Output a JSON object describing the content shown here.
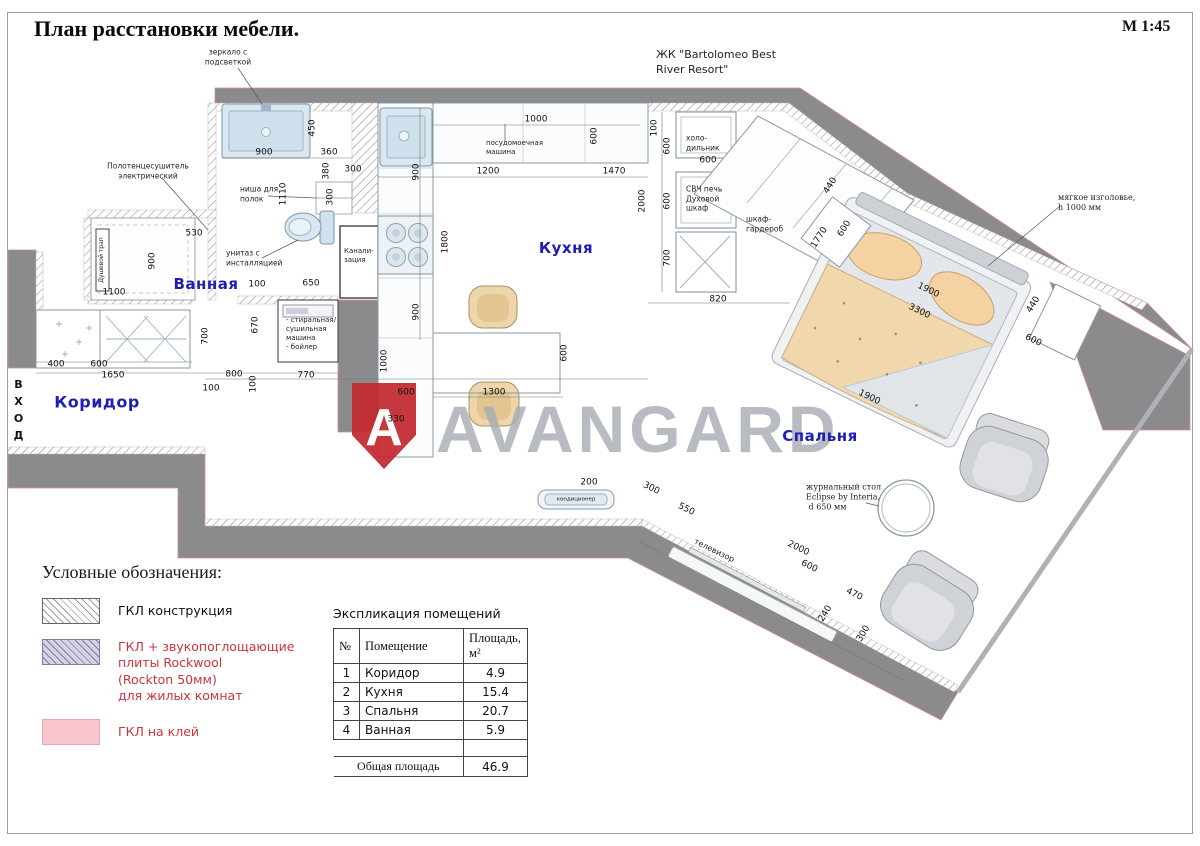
{
  "header": {
    "title": "План расстановки мебели.",
    "scale": "М 1:45",
    "project": "ЖК \"Bartolomeo Best\nRiver Resort\""
  },
  "entrance": {
    "label": "ВХОД"
  },
  "watermark": {
    "text": "AVANGARD",
    "logo_letter": "A",
    "logo_color": "#c32a30",
    "text_color": "#a8acb4"
  },
  "colors": {
    "wall_gray": "#8b8b8e",
    "room_label_blue": "#2020b0",
    "legend_red": "#cc3340",
    "fixture_blue": "#d8e7f1",
    "furniture_tan": "#edd6ab"
  },
  "rooms": [
    {
      "name": "Ванная",
      "x": 206,
      "y": 284
    },
    {
      "name": "Коридор",
      "x": 97,
      "y": 402,
      "s": 16
    },
    {
      "name": "Кухня",
      "x": 566,
      "y": 248
    },
    {
      "name": "Спальня",
      "x": 820,
      "y": 436
    }
  ],
  "dims": [
    {
      "t": "450",
      "x": 313,
      "y": 128,
      "r": -90
    },
    {
      "t": "900",
      "x": 264,
      "y": 153
    },
    {
      "t": "360",
      "x": 329,
      "y": 153
    },
    {
      "t": "380",
      "x": 327,
      "y": 171,
      "r": -90
    },
    {
      "t": "300",
      "x": 353,
      "y": 170
    },
    {
      "t": "300",
      "x": 331,
      "y": 197,
      "r": -90
    },
    {
      "t": "1110",
      "x": 284,
      "y": 194,
      "r": -90
    },
    {
      "t": "530",
      "x": 194,
      "y": 234
    },
    {
      "t": "900",
      "x": 153,
      "y": 261,
      "r": -90
    },
    {
      "t": "1100",
      "x": 114,
      "y": 293
    },
    {
      "t": "100",
      "x": 257,
      "y": 285
    },
    {
      "t": "650",
      "x": 311,
      "y": 284
    },
    {
      "t": "400",
      "x": 56,
      "y": 365
    },
    {
      "t": "600",
      "x": 99,
      "y": 365
    },
    {
      "t": "1650",
      "x": 113,
      "y": 376
    },
    {
      "t": "700",
      "x": 206,
      "y": 336,
      "r": -90
    },
    {
      "t": "670",
      "x": 256,
      "y": 325,
      "r": -90
    },
    {
      "t": "800",
      "x": 234,
      "y": 375
    },
    {
      "t": "100",
      "x": 211,
      "y": 389
    },
    {
      "t": "100",
      "x": 254,
      "y": 384,
      "r": -90
    },
    {
      "t": "770",
      "x": 306,
      "y": 376
    },
    {
      "t": "1000",
      "x": 536,
      "y": 120
    },
    {
      "t": "600",
      "x": 595,
      "y": 136,
      "r": -90
    },
    {
      "t": "100",
      "x": 655,
      "y": 128,
      "r": -90
    },
    {
      "t": "600",
      "x": 668,
      "y": 146,
      "r": -90
    },
    {
      "t": "900",
      "x": 417,
      "y": 172,
      "r": -90
    },
    {
      "t": "1200",
      "x": 488,
      "y": 172
    },
    {
      "t": "1470",
      "x": 614,
      "y": 172
    },
    {
      "t": "2000",
      "x": 643,
      "y": 201,
      "r": -90
    },
    {
      "t": "600",
      "x": 668,
      "y": 201,
      "r": -90
    },
    {
      "t": "1800",
      "x": 446,
      "y": 242,
      "r": -90
    },
    {
      "t": "700",
      "x": 668,
      "y": 258,
      "r": -90
    },
    {
      "t": "900",
      "x": 417,
      "y": 312,
      "r": -90
    },
    {
      "t": "600",
      "x": 708,
      "y": 161
    },
    {
      "t": "820",
      "x": 718,
      "y": 300
    },
    {
      "t": "440",
      "x": 831,
      "y": 186,
      "r": -58
    },
    {
      "t": "1770",
      "x": 820,
      "y": 238,
      "r": -58
    },
    {
      "t": "600",
      "x": 845,
      "y": 229,
      "r": -58
    },
    {
      "t": "1900",
      "x": 928,
      "y": 291,
      "r": 26
    },
    {
      "t": "3300",
      "x": 919,
      "y": 312,
      "r": 26
    },
    {
      "t": "440",
      "x": 1034,
      "y": 305,
      "r": -58
    },
    {
      "t": "600",
      "x": 1033,
      "y": 341,
      "r": 26
    },
    {
      "t": "1900",
      "x": 869,
      "y": 398,
      "r": 26
    },
    {
      "t": "1000",
      "x": 385,
      "y": 361,
      "r": -90
    },
    {
      "t": "600",
      "x": 406,
      "y": 393
    },
    {
      "t": "330",
      "x": 396,
      "y": 420
    },
    {
      "t": "1300",
      "x": 494,
      "y": 393
    },
    {
      "t": "600",
      "x": 565,
      "y": 353,
      "r": -90
    },
    {
      "t": "200",
      "x": 589,
      "y": 483
    },
    {
      "t": "300",
      "x": 651,
      "y": 489,
      "r": 26
    },
    {
      "t": "550",
      "x": 686,
      "y": 510,
      "r": 26
    },
    {
      "t": "2000",
      "x": 798,
      "y": 549,
      "r": 26
    },
    {
      "t": "600",
      "x": 809,
      "y": 567,
      "r": 26
    },
    {
      "t": "470",
      "x": 854,
      "y": 595,
      "r": 26
    },
    {
      "t": "240",
      "x": 826,
      "y": 614,
      "r": -58
    },
    {
      "t": "300",
      "x": 864,
      "y": 634,
      "r": -58
    }
  ],
  "annotations": [
    {
      "t": "зеркало с\nподсветкой",
      "x": 228,
      "y": 57,
      "a": "c"
    },
    {
      "t": "Полотенцесушитель\nэлектрический",
      "x": 148,
      "y": 171,
      "a": "c"
    },
    {
      "t": "ниша для\nполок",
      "x": 240,
      "y": 194
    },
    {
      "t": "унитаз с\nинсталляцией",
      "x": 226,
      "y": 258
    },
    {
      "t": "Канали-\nзация",
      "x": 344,
      "y": 256,
      "s": 7
    },
    {
      "t": "посудомоечная\nмашина",
      "x": 486,
      "y": 148,
      "s": 7
    },
    {
      "t": "холо-\nдильник",
      "x": 686,
      "y": 143,
      "s": 7.5
    },
    {
      "t": "СВЧ печь\nДуховой\nшкаф",
      "x": 686,
      "y": 199,
      "s": 7.5
    },
    {
      "t": "шкаф-\nгардероб",
      "x": 746,
      "y": 224,
      "s": 7.5
    },
    {
      "t": "мягкое изголовье,\nh 1000 мм",
      "x": 1058,
      "y": 203,
      "s": 8,
      "f": 1
    },
    {
      "t": "- стиральная/\nсушильная\nмашина\n- бойлер",
      "x": 286,
      "y": 334,
      "s": 7
    },
    {
      "t": "журнальный стол\nEclipse by Interia,\n d 650 мм",
      "x": 806,
      "y": 498,
      "s": 8,
      "f": 1
    },
    {
      "t": "телевизор",
      "x": 714,
      "y": 551,
      "r": 26,
      "s": 8,
      "a": "c"
    },
    {
      "t": "кондиционер",
      "x": 576,
      "y": 500,
      "s": 5.5,
      "a": "c"
    },
    {
      "t": "Душевой трап",
      "x": 102,
      "y": 260,
      "r": -90,
      "s": 6,
      "a": "c"
    }
  ],
  "legend": {
    "title": "Условные обозначения:",
    "items": [
      {
        "label": "ГКЛ конструкция",
        "swatch": "sw-hatch-gray",
        "red": false
      },
      {
        "label": "ГКЛ + звукопоглощающие\nплиты Rockwool\n(Rockton 50мм)\nдля жилых комнат",
        "swatch": "sw-hatch-purple",
        "red": true
      },
      {
        "label": "ГКЛ на клей",
        "swatch": "sw-pink",
        "red": true
      }
    ]
  },
  "area_table": {
    "title": "Экспликация  помещений",
    "headers": [
      "№",
      "Помещение",
      "Площадь,\nм²"
    ],
    "rows": [
      [
        "1",
        "Коридор",
        "4.9"
      ],
      [
        "2",
        "Кухня",
        "15.4"
      ],
      [
        "3",
        "Спальня",
        "20.7"
      ],
      [
        "4",
        "Ванная",
        "5.9"
      ]
    ],
    "total_label": "Общая площадь",
    "total_value": "46.9"
  }
}
